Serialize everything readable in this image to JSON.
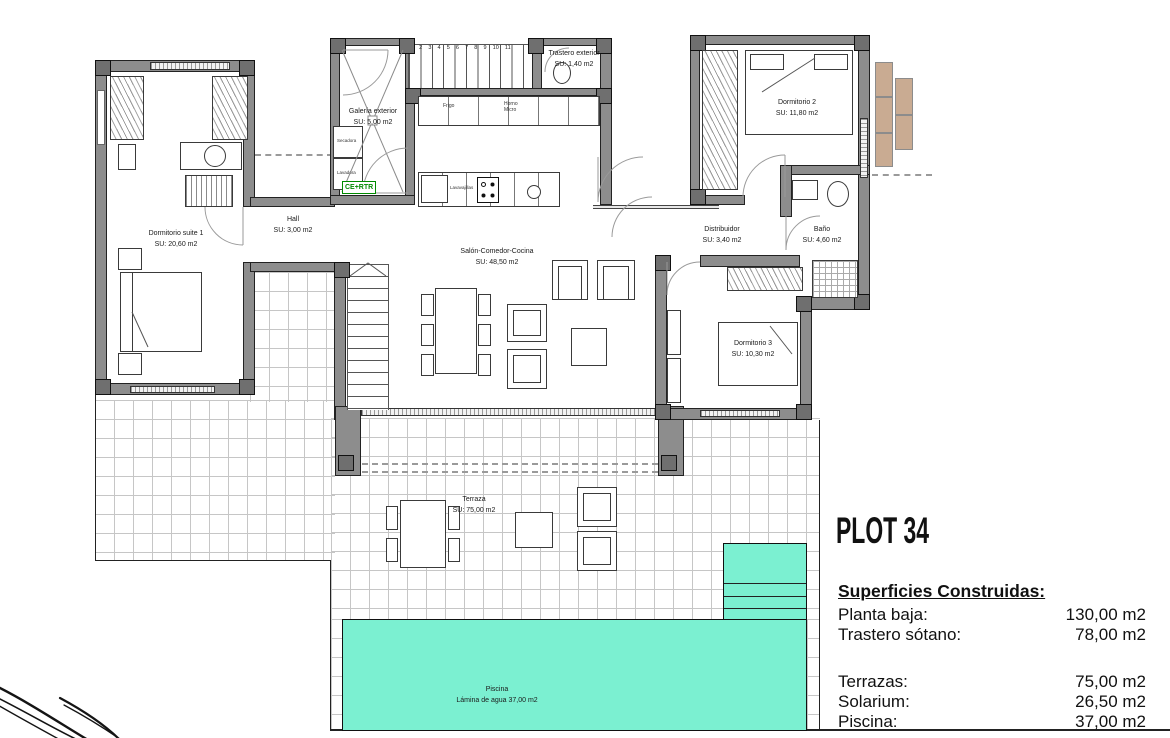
{
  "plan": {
    "rooms": [
      {
        "name": "Dormitorio suite 1",
        "su": "SU:  20,60 m2"
      },
      {
        "name": "Hall",
        "su": "SU:  3,00 m2"
      },
      {
        "name": "Galería exterior",
        "su": "SU:  5,00 m2"
      },
      {
        "name": "Trastero exterior",
        "su": "SU: 1,40 m2"
      },
      {
        "name": "Salón-Comedor-Cocina",
        "su": "SU:  48,50 m2"
      },
      {
        "name": "Dormitorio 2",
        "su": "SU:  11,80 m2"
      },
      {
        "name": "Distribuidor",
        "su": "SU:  3,40 m2"
      },
      {
        "name": "Baño",
        "su": "SU:  4,60 m2"
      },
      {
        "name": "Dormitorio 3",
        "su": "SU:  10,30 m2"
      },
      {
        "name": "Terraza",
        "su": "SU:  75,00 m2"
      },
      {
        "name": "Piscina",
        "su": "Lámina de agua 37,00 m2"
      }
    ],
    "labels": {
      "frigo": "Frigo",
      "horno_micro": "Horno Micro",
      "lavavajillas": "Lavavajillas",
      "secadora": "Secadora",
      "lavadora": "Lavadora",
      "ce_rtr": "CE+RTR",
      "stairs_numbers": "1 2 3 4 5 6 7 8 9 10 11"
    }
  },
  "legend": {
    "plot_title": "PLOT 34",
    "heading": "Superficies Construidas:",
    "groups": [
      {
        "rows": [
          {
            "label": "Planta baja:",
            "value": "130,00 m2"
          },
          {
            "label": "Trastero sótano:",
            "value": "78,00 m2"
          }
        ]
      },
      {
        "rows": [
          {
            "label": "Terrazas:",
            "value": "75,00 m2"
          },
          {
            "label": "Solarium:",
            "value": "26,50 m2"
          },
          {
            "label": "Piscina:",
            "value": "37,00 m2"
          }
        ]
      }
    ]
  },
  "colors": {
    "pool": "#7bf0d1",
    "wood": "#c9ab92",
    "accent_green": "#008a00"
  }
}
